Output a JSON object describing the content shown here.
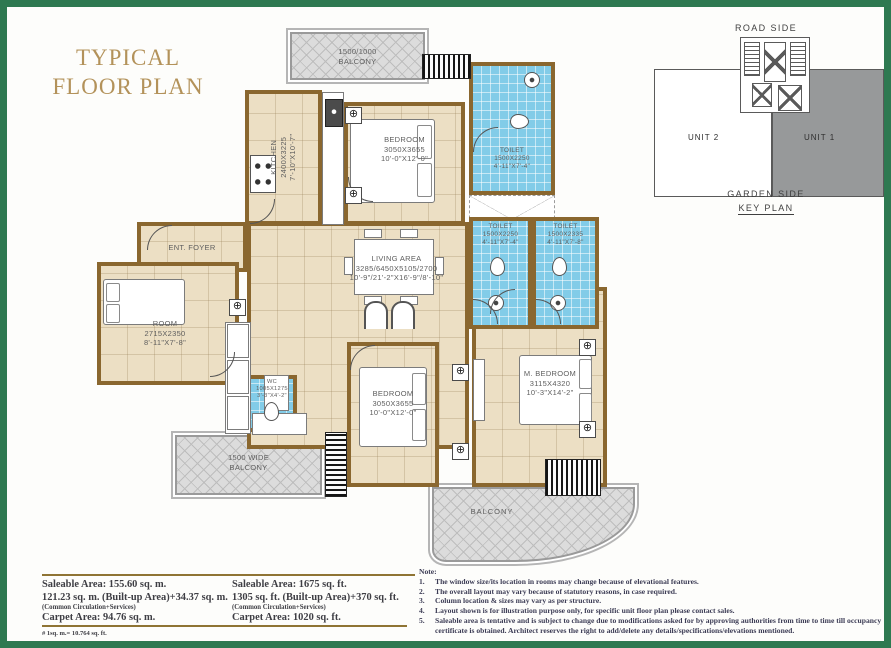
{
  "title": {
    "line1": "TYPICAL",
    "line2": "FLOOR PLAN"
  },
  "icons": {
    "column_marker": "⊕"
  },
  "key_plan": {
    "road_side": "ROAD SIDE",
    "unit_2": "UNIT 2",
    "unit_1": "UNIT 1",
    "garden_side": "GARDEN SIDE",
    "label": "KEY PLAN"
  },
  "plan": {
    "balcony_top": {
      "line1": "1500/1000",
      "line2": "BALCONY"
    },
    "kitchen": {
      "name": "KITCHEN",
      "mm": "2400X3225",
      "ft": "7'-10\"X10'-7\""
    },
    "bedroom_top": {
      "name": "BEDROOM",
      "mm": "3050X3655",
      "ft": "10'-0\"X12'-0\""
    },
    "toilet_top": {
      "name": "TOILET",
      "mm": "1500X2250",
      "ft": "4'-11\"X7'-4\""
    },
    "toilet_mid_left": {
      "name": "TOILET",
      "mm": "1500X2250",
      "ft": "4'-11\"X7'-4\""
    },
    "toilet_mid_right": {
      "name": "TOILET",
      "mm": "1500X2335",
      "ft": "4'-11\"X7'-8\""
    },
    "ent_foyer": {
      "name": "ENT. FOYER"
    },
    "living": {
      "name": "LIVING AREA",
      "mm": "3285/6450X5105/2700",
      "ft": "10'-9\"/21'-2\"X16'-9\"/8'-10\""
    },
    "room": {
      "name": "ROOM",
      "mm": "2715X2350",
      "ft": "8'-11\"X7'-8\""
    },
    "wc": {
      "name": "WC",
      "mm": "1005X1275",
      "ft": "3'-3\"X4'-2\""
    },
    "bedroom_bottom": {
      "name": "BEDROOM",
      "mm": "3050X3655",
      "ft": "10'-0\"X12'-0\""
    },
    "m_bedroom": {
      "name": "M. BEDROOM",
      "mm": "3115X4320",
      "ft": "10'-3\"X14'-2\""
    },
    "balcony_left": {
      "line1": "1500 WIDE",
      "line2": "BALCONY"
    },
    "balcony_bottom": {
      "name": "BALCONY"
    }
  },
  "areas": {
    "metric": {
      "saleable": "Saleable Area: 155.60 sq. m.",
      "builtup": "121.23 sq. m. (Built-up Area)+34.37 sq. m.",
      "common": "(Common Circulation+Services)",
      "carpet": "Carpet Area: 94.76 sq. m."
    },
    "imperial": {
      "saleable": "Saleable Area: 1675 sq. ft.",
      "builtup": "1305 sq. ft. (Built-up Area)+370 sq. ft.",
      "common": "(Common Circulation+Services)",
      "carpet": "Carpet Area: 1020 sq. ft."
    },
    "footnote": "# 1sq. m.= 10.764 sq. ft."
  },
  "notes": {
    "heading": "Note:",
    "items": [
      {
        "num": "1.",
        "text": "The window size/its location in rooms may change because of elevational features."
      },
      {
        "num": "2.",
        "text": "The overall layout may vary because of statutory reasons, in case required."
      },
      {
        "num": "3.",
        "text": "Column location & sizes may vary as per structure."
      },
      {
        "num": "4.",
        "text": "Layout shown is for illustration purpose only, for specific unit floor plan please contact sales."
      },
      {
        "num": "5.",
        "text": "Saleable area is tentative and is subject to change due to modifications asked for by approving authorities from time to time till occupancy certificate is obtained. Architect reserves the right to add/delete any details/specifications/elevations mentioned."
      }
    ]
  },
  "colors": {
    "border_green": "#2e7951",
    "title_gold": "#b3925a",
    "wall_brown": "#8a672f",
    "floor_beige": "#ecdfc4",
    "toilet_blue": "#82cce8",
    "balcony_gray": "#dcdcdc",
    "rule_gold": "#8f7434"
  }
}
